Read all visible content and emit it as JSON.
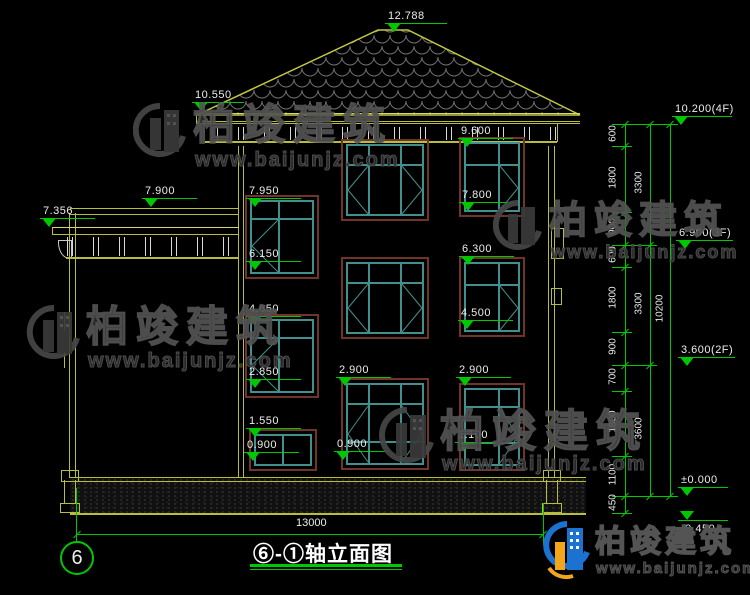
{
  "title": {
    "text": "⑥-①轴立面图"
  },
  "axis": {
    "bubble": "6"
  },
  "watermark": {
    "brand": "柏竣建筑",
    "url": "www.baijunjz.com"
  },
  "logo": {
    "brand": "柏竣建筑",
    "url": "www.baijunjz.com"
  },
  "markers": [
    "12.788",
    "10.550",
    "7.900",
    "7.356",
    "7.950",
    "6.150",
    "4.650",
    "2.850",
    "1.550",
    "0.900",
    "9.600",
    "7.800",
    "6.300",
    "4.500",
    "2.900",
    "0.900",
    "2.900",
    "1.100"
  ],
  "dims": {
    "segments": [
      "600",
      "1800",
      "900",
      "600",
      "1800",
      "900",
      "700",
      "1800",
      "1100",
      "450"
    ],
    "subtotals": [
      "3300",
      "3300",
      "3600"
    ],
    "total": "10200",
    "bottom_width": "13000"
  },
  "floor_levels": [
    "10.200(4F)",
    "6.900(3F)",
    "3.600(2F)",
    "±0.000",
    "-0.450"
  ],
  "colors": {
    "line_yellow": "#b9bd3c",
    "dim_green": "#00c800",
    "window_teal": "#41908d",
    "window_frame_brown": "#70352a",
    "background": "#000000"
  }
}
